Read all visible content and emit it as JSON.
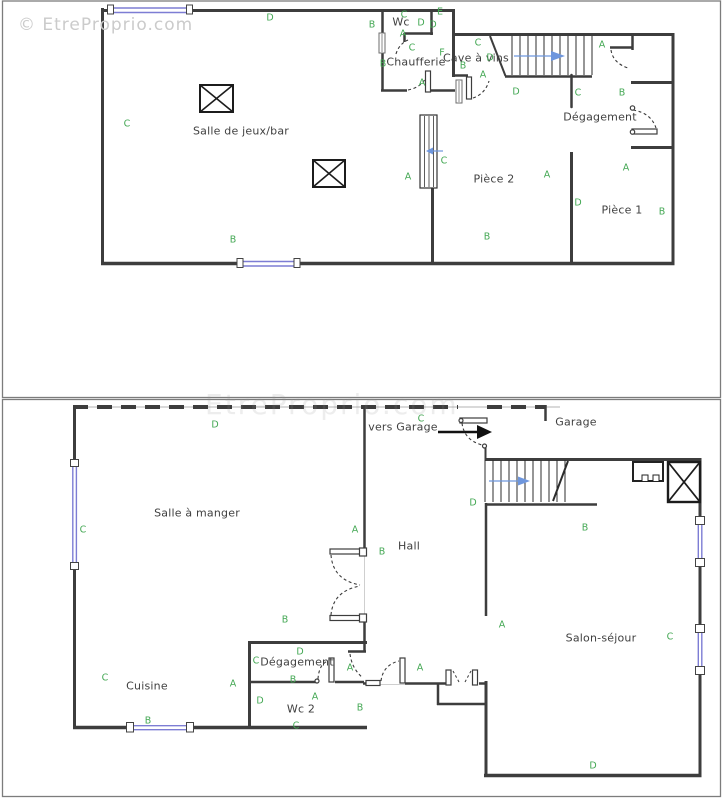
{
  "watermark": {
    "text": "© EtreProprio.com"
  },
  "watermark_faint": {
    "text": "EtreProprio.com"
  },
  "colors": {
    "wall": "#3d3d3d",
    "window_blue": "#7d7dd4",
    "marker_green": "#44a854",
    "label_gray": "#3f3f3f",
    "stair_arrow_blue": "#6e96dd",
    "watermark_gray": "#cbcbcb"
  },
  "plans": [
    {
      "id": "upper",
      "rooms": [
        {
          "text": "Salle de jeux/bar",
          "x": 241,
          "y": 131
        },
        {
          "text": "Wc",
          "x": 401,
          "y": 22
        },
        {
          "text": "Chaufferie",
          "x": 416,
          "y": 62
        },
        {
          "text": "Cave à vins",
          "x": 476,
          "y": 58
        },
        {
          "text": "Dégagement",
          "x": 600,
          "y": 117
        },
        {
          "text": "Pièce 2",
          "x": 494,
          "y": 179
        },
        {
          "text": "Pièce 1",
          "x": 622,
          "y": 210
        }
      ],
      "markers": [
        {
          "t": "C",
          "x": 127,
          "y": 124
        },
        {
          "t": "D",
          "x": 270,
          "y": 18
        },
        {
          "t": "B",
          "x": 372,
          "y": 25
        },
        {
          "t": "C",
          "x": 404,
          "y": 15
        },
        {
          "t": "E",
          "x": 440,
          "y": 12
        },
        {
          "t": "D",
          "x": 421,
          "y": 23
        },
        {
          "t": "D",
          "x": 433,
          "y": 25
        },
        {
          "t": "A",
          "x": 403,
          "y": 34
        },
        {
          "t": "C",
          "x": 412,
          "y": 48
        },
        {
          "t": "F",
          "x": 442,
          "y": 53
        },
        {
          "t": "B",
          "x": 383,
          "y": 64
        },
        {
          "t": "A",
          "x": 422,
          "y": 83
        },
        {
          "t": "C",
          "x": 478,
          "y": 43
        },
        {
          "t": "D",
          "x": 490,
          "y": 58
        },
        {
          "t": "B",
          "x": 463,
          "y": 66
        },
        {
          "t": "A",
          "x": 483,
          "y": 75
        },
        {
          "t": "D",
          "x": 516,
          "y": 92
        },
        {
          "t": "C",
          "x": 578,
          "y": 93
        },
        {
          "t": "A",
          "x": 602,
          "y": 45
        },
        {
          "t": "B",
          "x": 622,
          "y": 93
        },
        {
          "t": "A",
          "x": 408,
          "y": 177
        },
        {
          "t": "C",
          "x": 444,
          "y": 161
        },
        {
          "t": "A",
          "x": 547,
          "y": 175
        },
        {
          "t": "B",
          "x": 487,
          "y": 237
        },
        {
          "t": "D",
          "x": 578,
          "y": 203
        },
        {
          "t": "A",
          "x": 626,
          "y": 168
        },
        {
          "t": "B",
          "x": 662,
          "y": 212
        },
        {
          "t": "B",
          "x": 233,
          "y": 240
        }
      ]
    },
    {
      "id": "lower",
      "rooms": [
        {
          "text": "Salle à manger",
          "x": 197,
          "y": 513
        },
        {
          "text": "Hall",
          "x": 409,
          "y": 546
        },
        {
          "text": "vers Garage",
          "x": 403,
          "y": 427
        },
        {
          "text": "Garage",
          "x": 576,
          "y": 422
        },
        {
          "text": "Salon-séjour",
          "x": 601,
          "y": 638
        },
        {
          "text": "Cuisine",
          "x": 147,
          "y": 686
        },
        {
          "text": "Dégagement",
          "x": 297,
          "y": 662
        },
        {
          "text": "Wc 2",
          "x": 301,
          "y": 709
        }
      ],
      "markers": [
        {
          "t": "D",
          "x": 215,
          "y": 425
        },
        {
          "t": "C",
          "x": 421,
          "y": 419
        },
        {
          "t": "C",
          "x": 83,
          "y": 530
        },
        {
          "t": "A",
          "x": 355,
          "y": 530
        },
        {
          "t": "B",
          "x": 382,
          "y": 552
        },
        {
          "t": "B",
          "x": 285,
          "y": 620
        },
        {
          "t": "A",
          "x": 502,
          "y": 625
        },
        {
          "t": "D",
          "x": 473,
          "y": 503
        },
        {
          "t": "B",
          "x": 585,
          "y": 528
        },
        {
          "t": "A",
          "x": 350,
          "y": 668
        },
        {
          "t": "A",
          "x": 420,
          "y": 668
        },
        {
          "t": "C",
          "x": 256,
          "y": 661
        },
        {
          "t": "D",
          "x": 300,
          "y": 652
        },
        {
          "t": "B",
          "x": 293,
          "y": 680
        },
        {
          "t": "A",
          "x": 315,
          "y": 697
        },
        {
          "t": "D",
          "x": 260,
          "y": 701
        },
        {
          "t": "C",
          "x": 296,
          "y": 726
        },
        {
          "t": "B",
          "x": 360,
          "y": 708
        },
        {
          "t": "C",
          "x": 105,
          "y": 678
        },
        {
          "t": "A",
          "x": 233,
          "y": 684
        },
        {
          "t": "B",
          "x": 148,
          "y": 721
        },
        {
          "t": "C",
          "x": 670,
          "y": 637
        },
        {
          "t": "D",
          "x": 593,
          "y": 766
        }
      ]
    }
  ]
}
